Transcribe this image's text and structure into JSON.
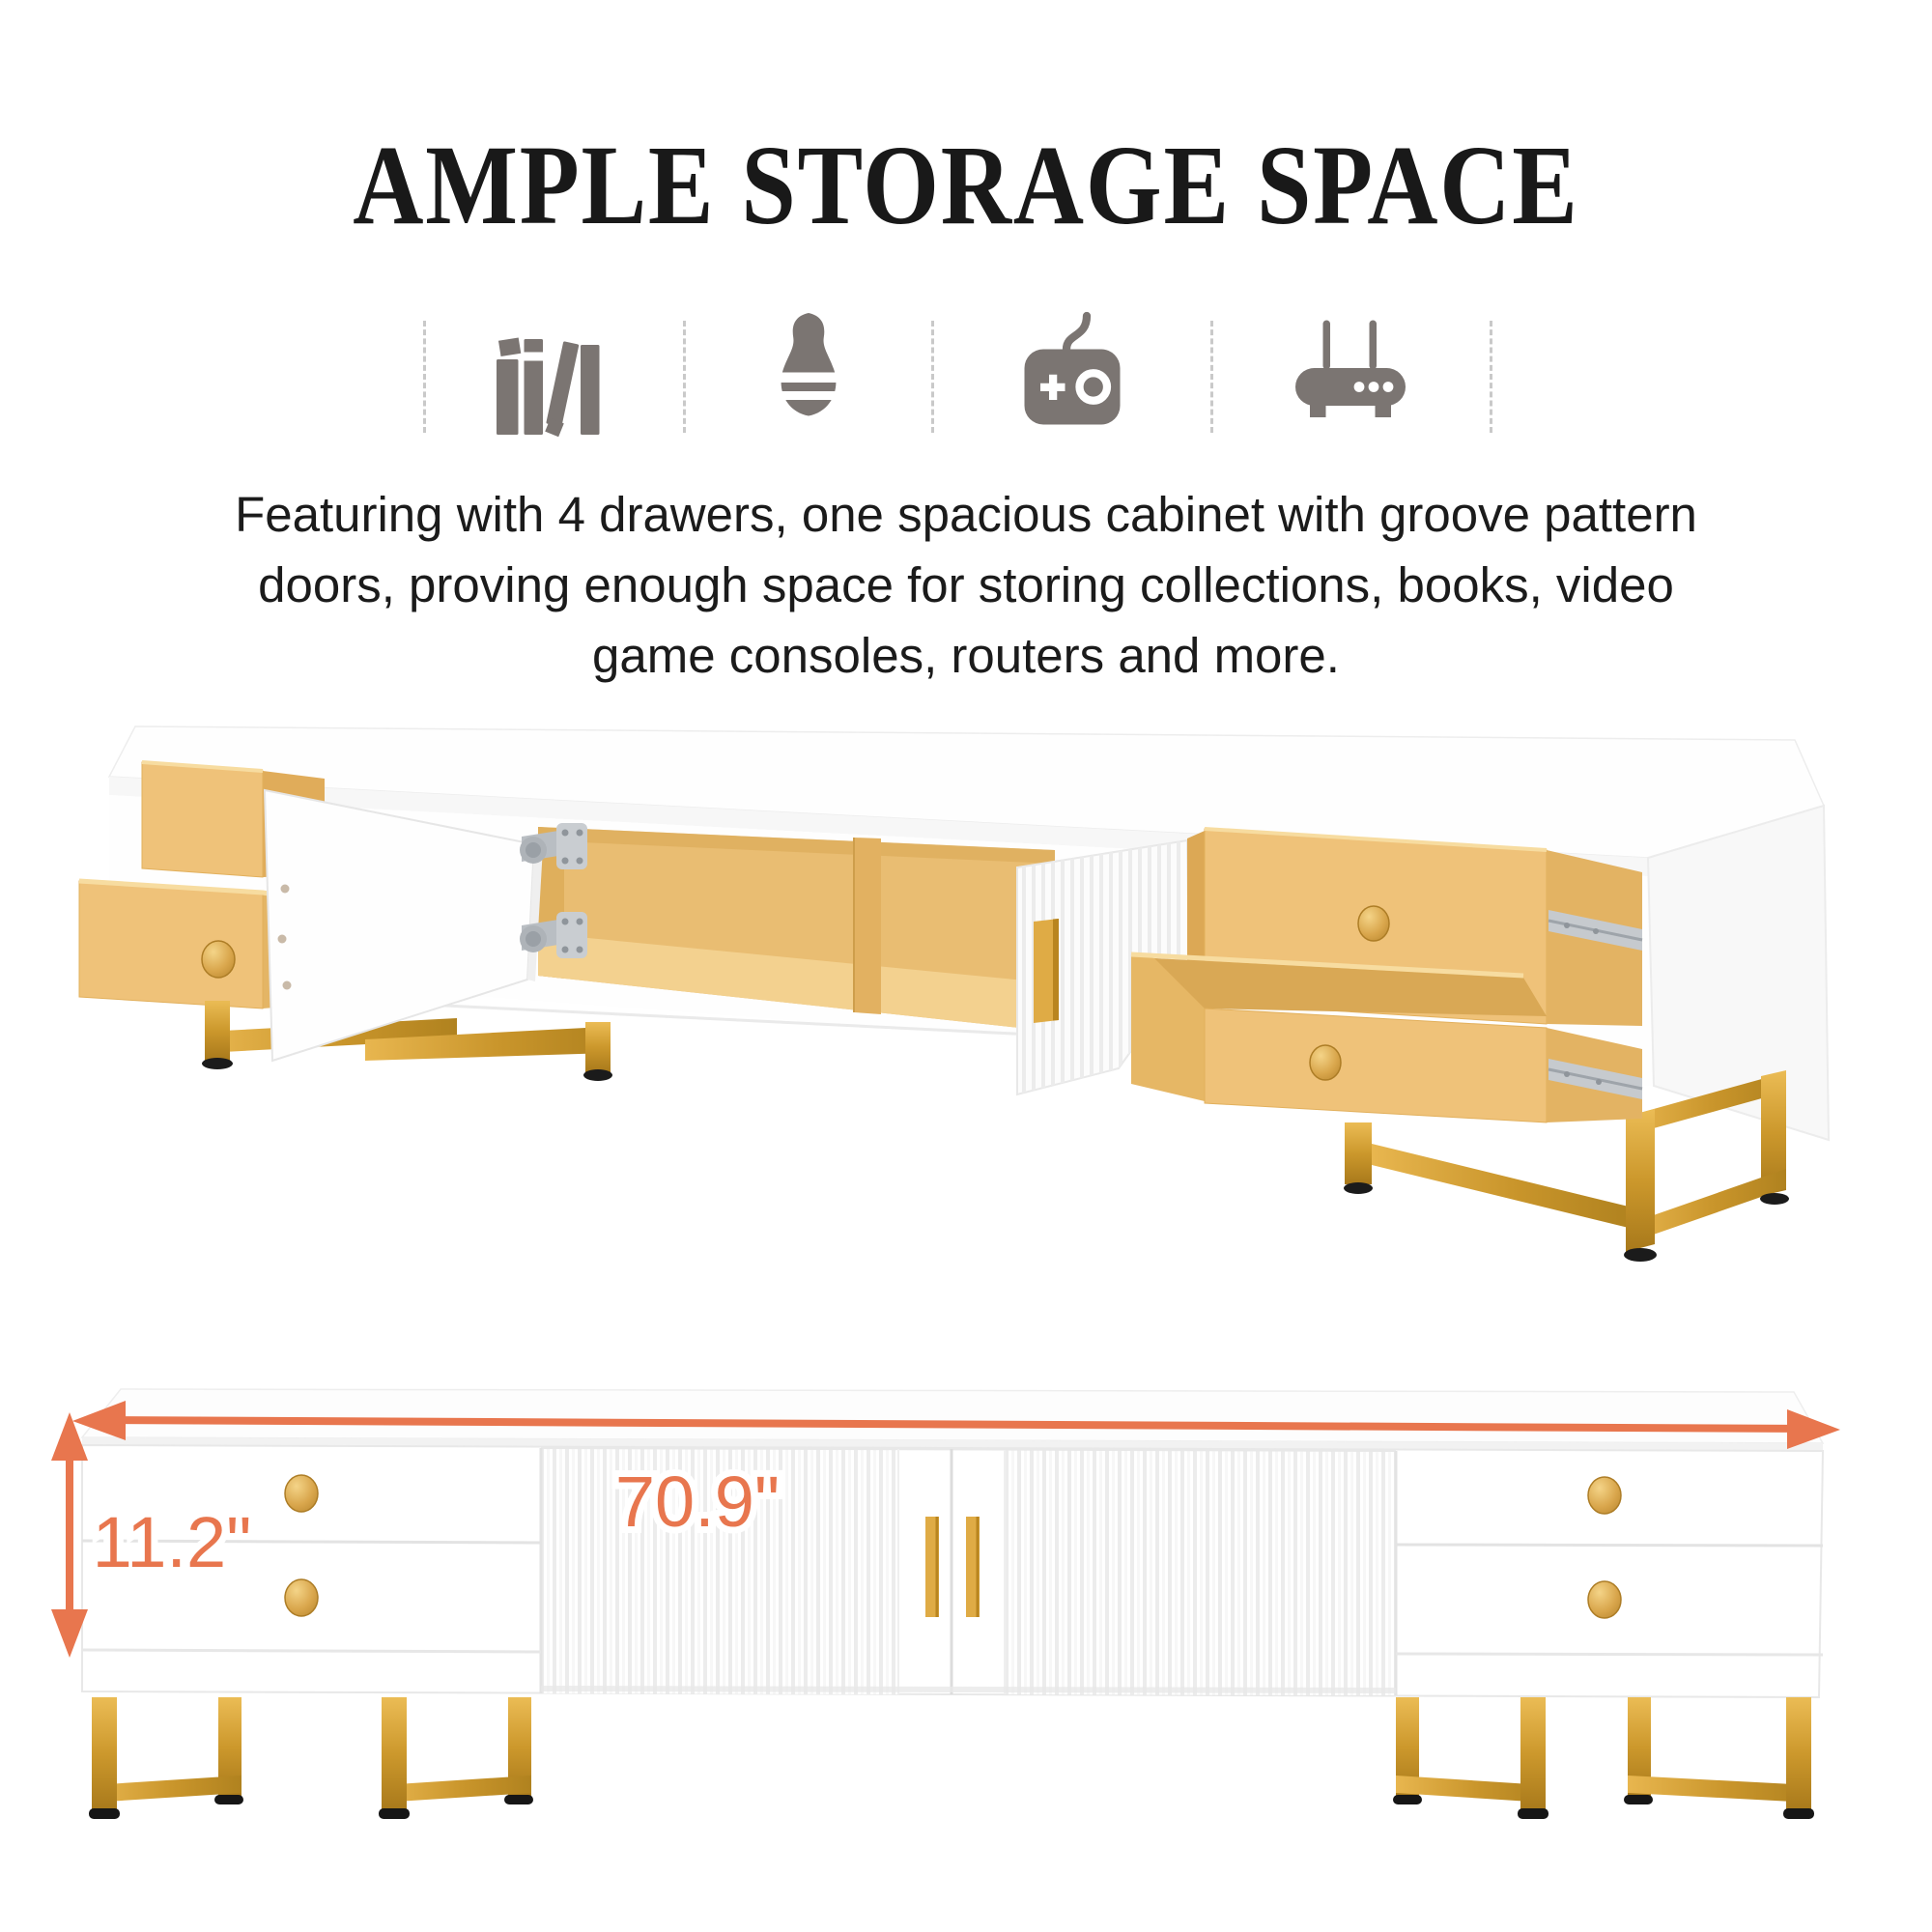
{
  "header": {
    "title": "AMPLE STORAGE SPACE"
  },
  "features": {
    "icons": [
      {
        "name": "books-icon",
        "meaning": "books / collections storage"
      },
      {
        "name": "vase-icon",
        "meaning": "decor storage"
      },
      {
        "name": "game-controller-icon",
        "meaning": "video game consoles storage"
      },
      {
        "name": "router-icon",
        "meaning": "router storage"
      }
    ]
  },
  "description": {
    "lines": [
      "Featuring with 4 drawers, one spacious cabinet with groove pattern",
      "doors, proving enough space for storing collections, books, video",
      "game consoles, routers and more."
    ]
  },
  "product": {
    "top_view": "TV stand opened: 4 yellow drawers pulled out, two white doors open, yellow cabinet interior, gold metal sled legs",
    "bottom_view": "TV stand front view with groove pattern doors, gold handles and knobs, gold sled legs"
  },
  "dimensions": {
    "width_label": "70.9\"",
    "height_label": "11.2\""
  },
  "colors": {
    "accent-orange": "#E8764E",
    "gold": "#C9952B",
    "gold-light": "#E8B64F",
    "gold-dark": "#A8791B",
    "drawer-yellow": "#EFC279",
    "drawer-yellow-side": "#E3B363",
    "interior-yellow": "#E9BD72",
    "interior-floor": "#F3D18F",
    "icon-gray": "#7B7572",
    "text-black": "#1B1B1B"
  }
}
